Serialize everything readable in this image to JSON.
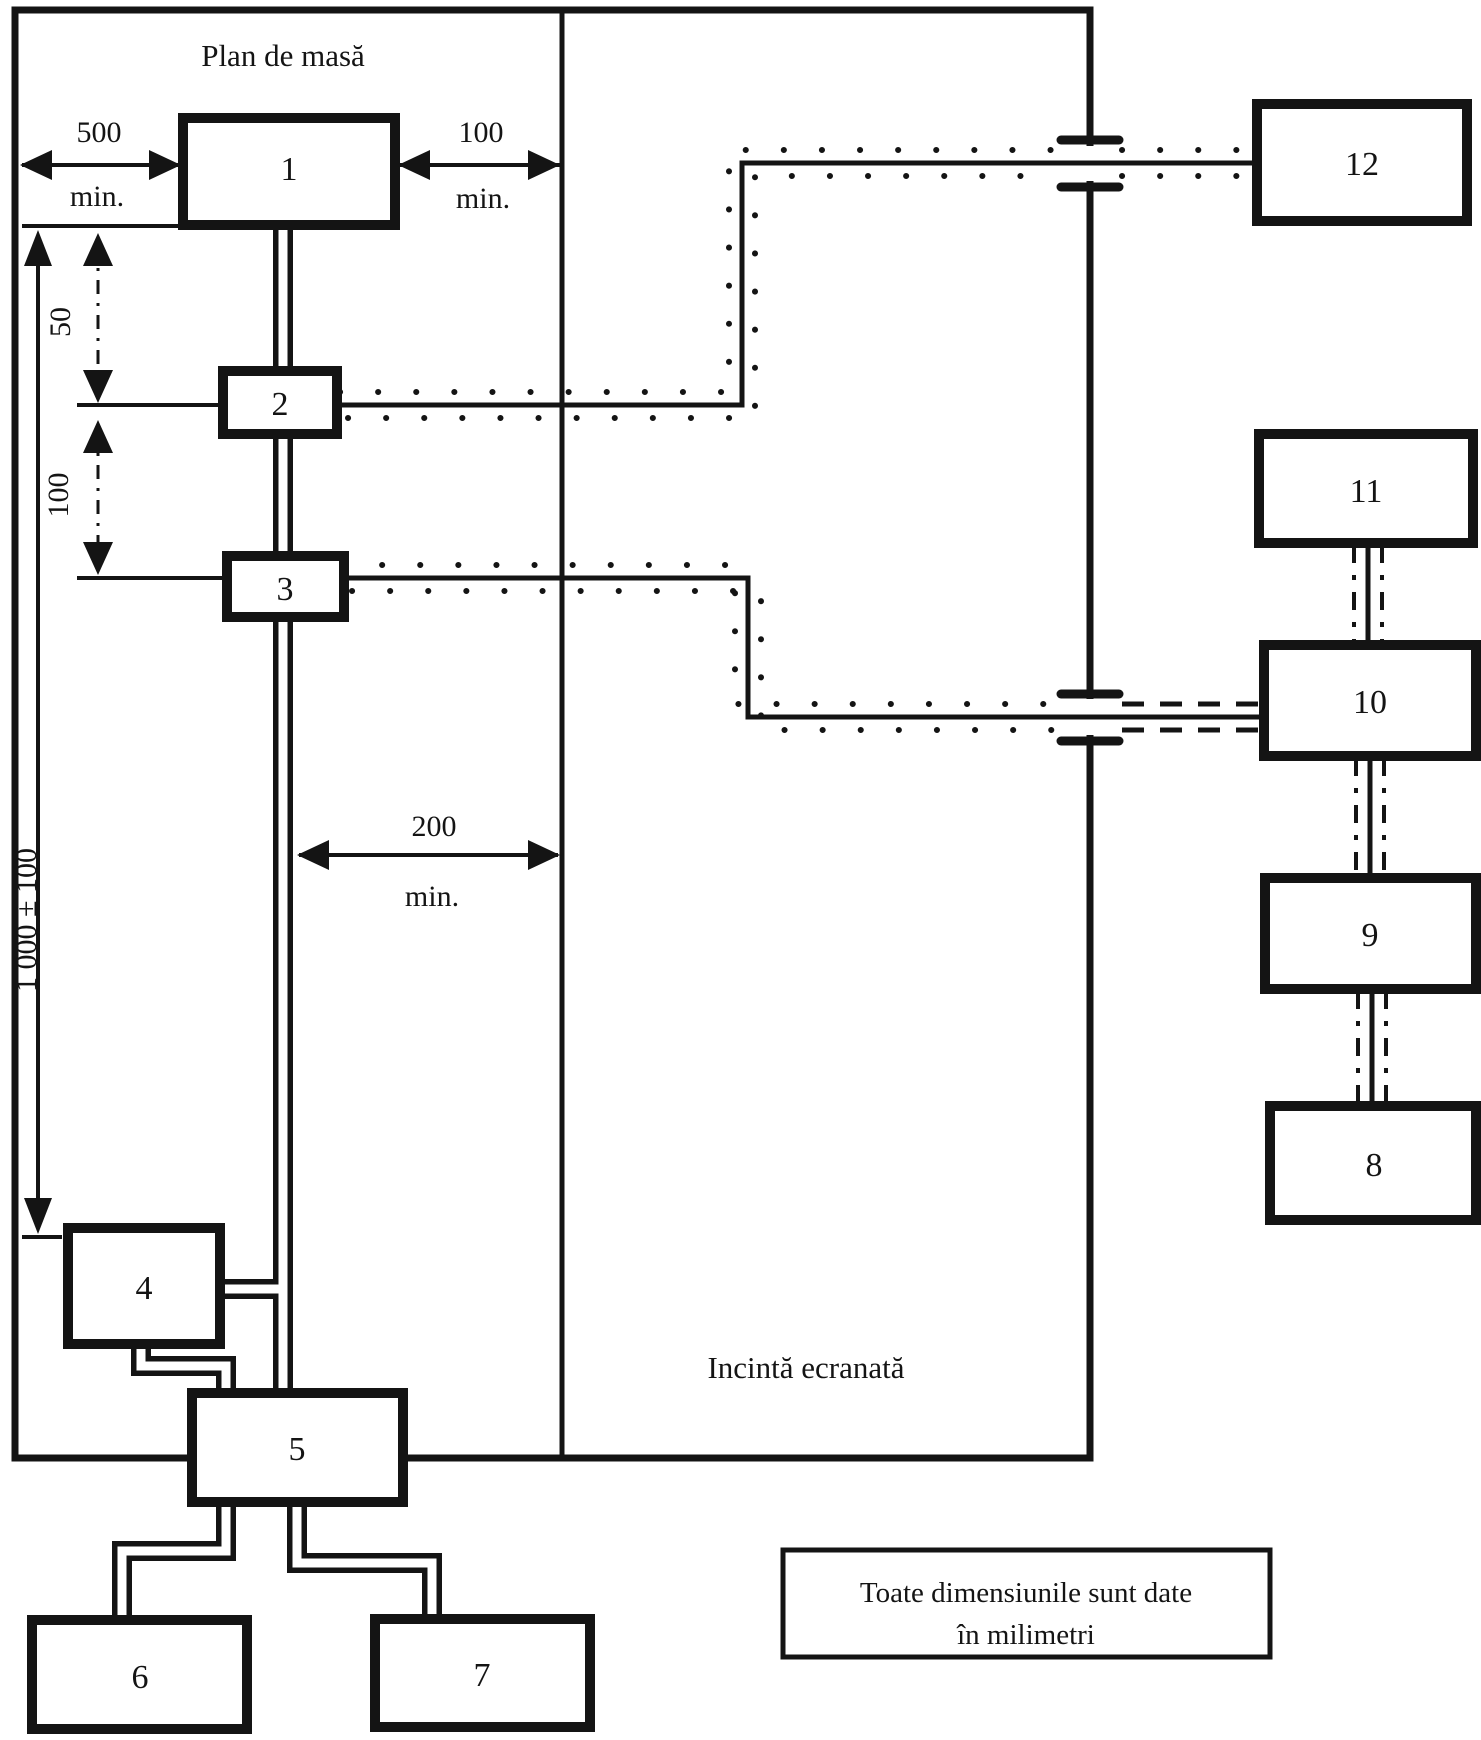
{
  "diagram": {
    "title": "Plan de masă",
    "enclosure_label": "Incintă ecranată",
    "note": {
      "line1": "Toate dimensiunile sunt date",
      "line2": "în milimetri"
    },
    "boxes": {
      "b1": "1",
      "b2": "2",
      "b3": "3",
      "b4": "4",
      "b5": "5",
      "b6": "6",
      "b7": "7",
      "b8": "8",
      "b9": "9",
      "b10": "10",
      "b11": "11",
      "b12": "12"
    },
    "dimensions": {
      "left_clearance": "500",
      "left_clearance_min": "min.",
      "right_clearance": "100",
      "right_clearance_min": "min.",
      "height_50": "50",
      "height_100": "100",
      "height_total": "1 000 ± 100",
      "edge_distance": "200",
      "edge_distance_min": "min."
    },
    "colors": {
      "ink": "#141414",
      "paper": "#ffffff"
    }
  }
}
